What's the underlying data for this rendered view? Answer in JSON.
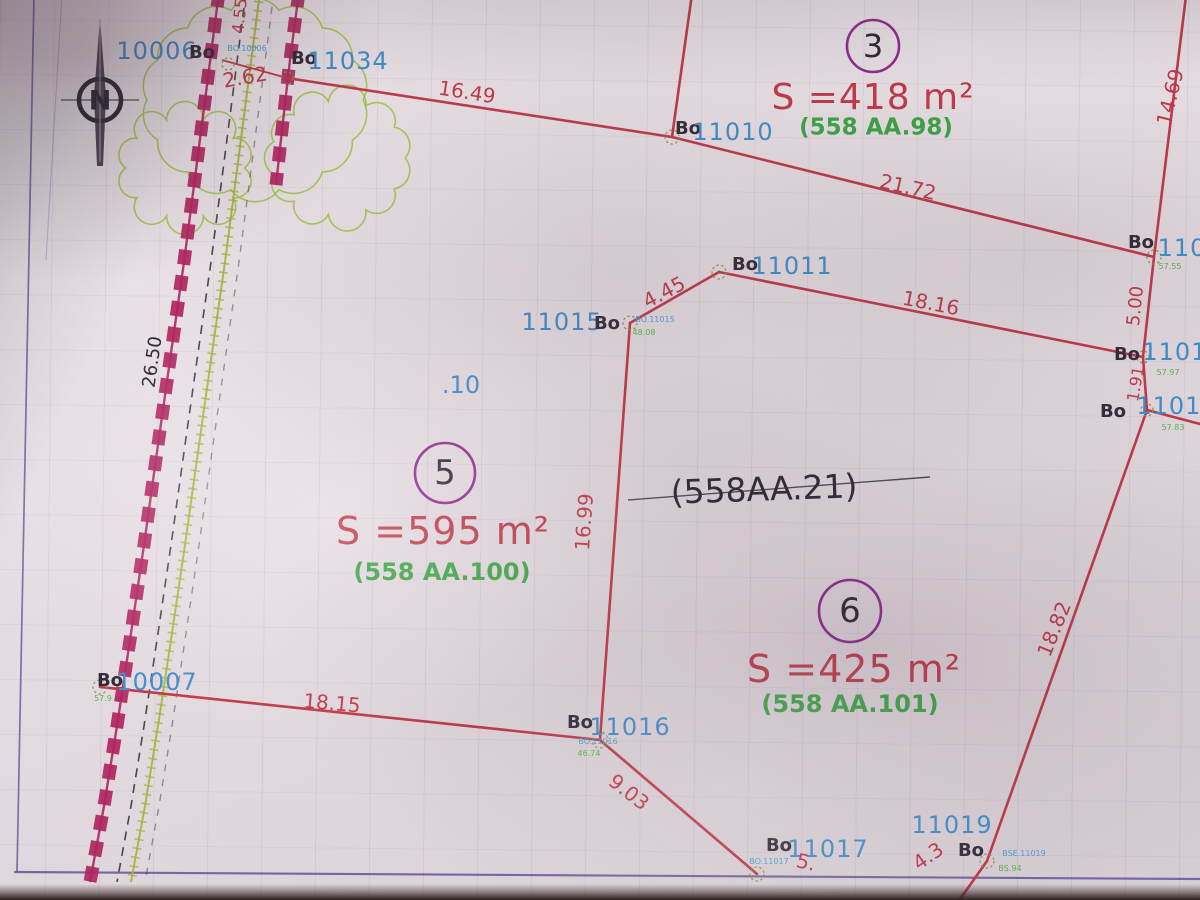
{
  "palette": {
    "paper": "#e8e0e4",
    "red": "#c03848",
    "blue": "#3e8ecb",
    "tinyblue": "#4aa4d8",
    "green": "#3aa543",
    "tinygreen": "#58b84a",
    "ink": "#2e2733",
    "dark": "#312a36",
    "magenta": "#b02560",
    "purple": "#8e2a8e",
    "olive": "#a8b23c",
    "treegreen": "#9cc53e",
    "frame": "#584d92",
    "marker": "#8f9440"
  },
  "north": {
    "label": "N"
  },
  "parcels": [
    {
      "number": "3",
      "area": "S =418 m²",
      "ref": "(558 AA.98)"
    },
    {
      "number": "5",
      "area": "S =595 m²",
      "ref": "(558 AA.100)"
    },
    {
      "number": "6",
      "area": "S =425 m²",
      "ref": "(558 AA.101)"
    }
  ],
  "crossed_out_ref": "(558AA.21)",
  "labels": [
    {
      "n": "point-label-10006",
      "t": "10006",
      "x": 157,
      "y": 51,
      "s": 24,
      "c": "blue",
      "ls": 1
    },
    {
      "n": "bo-prefix-10006",
      "t": "Bo",
      "x": 202,
      "y": 53,
      "s": 18,
      "c": "dark",
      "w": 700
    },
    {
      "n": "point-sublabel-10006",
      "t": "BO.10006",
      "x": 247,
      "y": 49,
      "s": 8,
      "c": "tinyblue"
    },
    {
      "n": "bo-prefix-11034",
      "t": "Bo",
      "x": 304,
      "y": 59,
      "s": 18,
      "c": "dark",
      "w": 700
    },
    {
      "n": "point-label-11034",
      "t": "11034",
      "x": 348,
      "y": 61,
      "s": 24,
      "c": "blue",
      "ls": 1
    },
    {
      "n": "dimension-2-62",
      "t": "2.62",
      "x": 245,
      "y": 77,
      "s": 20,
      "c": "red",
      "r": -10
    },
    {
      "n": "dimension-4-55",
      "t": "4.55",
      "x": 240,
      "y": 16,
      "s": 16,
      "c": "red",
      "r": -84
    },
    {
      "n": "dimension-26-50",
      "t": "26.50",
      "x": 153,
      "y": 362,
      "s": 18,
      "c": "ink",
      "r": -82
    },
    {
      "n": "dimension-16-49",
      "t": "16.49",
      "x": 467,
      "y": 92,
      "s": 20,
      "c": "red",
      "r": 9
    },
    {
      "n": "bo-prefix-11010",
      "t": "Bo",
      "x": 688,
      "y": 129,
      "s": 18,
      "c": "dark",
      "w": 700
    },
    {
      "n": "point-label-11010",
      "t": "11010",
      "x": 733,
      "y": 132,
      "s": 24,
      "c": "blue",
      "ls": 1
    },
    {
      "n": "dimension-21-72",
      "t": "21.72",
      "x": 908,
      "y": 187,
      "s": 20,
      "c": "red",
      "r": 13
    },
    {
      "n": "parcel-3-number",
      "bind": "parcels.0.number",
      "x": 873,
      "y": 46,
      "s": 32,
      "c": "ink"
    },
    {
      "n": "parcel-3-area",
      "bind": "parcels.0.area",
      "x": 873,
      "y": 98,
      "s": 36,
      "c": "red",
      "ls": 1
    },
    {
      "n": "parcel-3-ref",
      "bind": "parcels.0.ref",
      "x": 876,
      "y": 128,
      "s": 23,
      "c": "green",
      "w": 700
    },
    {
      "n": "dimension-14-69",
      "t": "14.69",
      "x": 1170,
      "y": 97,
      "s": 20,
      "c": "red",
      "r": -76
    },
    {
      "n": "bo-prefix-11012",
      "t": "Bo",
      "x": 1141,
      "y": 243,
      "s": 18,
      "c": "dark",
      "w": 700
    },
    {
      "n": "point-label-11012",
      "t": "110",
      "x": 1182,
      "y": 248,
      "s": 24,
      "c": "blue",
      "ls": 1
    },
    {
      "n": "point-sublabel-11012",
      "t": "57.55",
      "x": 1170,
      "y": 267,
      "s": 8,
      "c": "tinygreen"
    },
    {
      "n": "dimension-5-00",
      "t": "5.00",
      "x": 1136,
      "y": 306,
      "s": 18,
      "c": "red",
      "r": -84
    },
    {
      "n": "bo-prefix-11013",
      "t": "Bo",
      "x": 1127,
      "y": 355,
      "s": 18,
      "c": "dark",
      "w": 700
    },
    {
      "n": "point-label-11013",
      "t": "11013",
      "x": 1183,
      "y": 352,
      "s": 24,
      "c": "blue",
      "ls": 1
    },
    {
      "n": "point-sublabel-11013",
      "t": "57.97",
      "x": 1168,
      "y": 373,
      "s": 8,
      "c": "tinygreen"
    },
    {
      "n": "dimension-1-91",
      "t": "1.91",
      "x": 1136,
      "y": 384,
      "s": 16,
      "c": "red",
      "r": -80
    },
    {
      "n": "bo-prefix-11014",
      "t": "Bo",
      "x": 1113,
      "y": 412,
      "s": 18,
      "c": "dark",
      "w": 700
    },
    {
      "n": "point-label-11014",
      "t": "11014",
      "x": 1177,
      "y": 406,
      "s": 24,
      "c": "blue",
      "ls": 1
    },
    {
      "n": "point-sublabel-11014",
      "t": "57.83",
      "x": 1173,
      "y": 428,
      "s": 8,
      "c": "tinygreen"
    },
    {
      "n": "bo-prefix-11011",
      "t": "Bo",
      "x": 745,
      "y": 265,
      "s": 18,
      "c": "dark",
      "w": 700
    },
    {
      "n": "point-label-11011",
      "t": "11011",
      "x": 792,
      "y": 266,
      "s": 24,
      "c": "blue",
      "ls": 1
    },
    {
      "n": "dimension-4-45",
      "t": "4.45",
      "x": 664,
      "y": 292,
      "s": 20,
      "c": "red",
      "r": -28
    },
    {
      "n": "point-label-11015",
      "t": "11015",
      "x": 562,
      "y": 322,
      "s": 24,
      "c": "blue",
      "ls": 1
    },
    {
      "n": "bo-prefix-11015",
      "t": "Bo",
      "x": 607,
      "y": 324,
      "s": 18,
      "c": "dark",
      "w": 700
    },
    {
      "n": "point-sublabel-11015a",
      "t": "BO.11015",
      "x": 655,
      "y": 320,
      "s": 8,
      "c": "tinyblue"
    },
    {
      "n": "point-sublabel-11015b",
      "t": "48.08",
      "x": 644,
      "y": 333,
      "s": 8,
      "c": "tinygreen"
    },
    {
      "n": "point-label-10",
      "t": ".10",
      "x": 461,
      "y": 385,
      "s": 24,
      "c": "blue"
    },
    {
      "n": "dimension-18-16",
      "t": "18.16",
      "x": 931,
      "y": 303,
      "s": 20,
      "c": "red",
      "r": 11
    },
    {
      "n": "crossed-ref",
      "bind": "crossed_out_ref",
      "x": 764,
      "y": 489,
      "s": 33,
      "c": "ink",
      "r": -2
    },
    {
      "n": "parcel-5-number",
      "bind": "parcels.1.number",
      "x": 445,
      "y": 473,
      "s": 34,
      "c": "ink"
    },
    {
      "n": "parcel-5-area",
      "bind": "parcels.1.area",
      "x": 443,
      "y": 531,
      "s": 38,
      "c": "red",
      "ls": 1
    },
    {
      "n": "parcel-5-ref",
      "bind": "parcels.1.ref",
      "x": 442,
      "y": 572,
      "s": 24,
      "c": "green",
      "w": 700
    },
    {
      "n": "dimension-16-99",
      "t": "16.99",
      "x": 584,
      "y": 522,
      "s": 20,
      "c": "red",
      "r": -86
    },
    {
      "n": "parcel-6-number",
      "bind": "parcels.2.number",
      "x": 850,
      "y": 611,
      "s": 34,
      "c": "ink"
    },
    {
      "n": "parcel-6-area",
      "bind": "parcels.2.area",
      "x": 854,
      "y": 669,
      "s": 38,
      "c": "red",
      "ls": 1
    },
    {
      "n": "parcel-6-ref",
      "bind": "parcels.2.ref",
      "x": 850,
      "y": 704,
      "s": 24,
      "c": "green",
      "w": 700
    },
    {
      "n": "dimension-18-82",
      "t": "18.82",
      "x": 1054,
      "y": 629,
      "s": 20,
      "c": "red",
      "r": -68
    },
    {
      "n": "bo-prefix-10007",
      "t": "Bo",
      "x": 110,
      "y": 681,
      "s": 18,
      "c": "dark",
      "w": 700
    },
    {
      "n": "point-label-10007",
      "t": "10007",
      "x": 157,
      "y": 682,
      "s": 24,
      "c": "blue",
      "ls": 1
    },
    {
      "n": "point-sublabel-10007",
      "t": "57.9",
      "x": 103,
      "y": 699,
      "s": 8,
      "c": "tinygreen"
    },
    {
      "n": "dimension-18-15",
      "t": "18.15",
      "x": 332,
      "y": 703,
      "s": 20,
      "c": "red",
      "r": 5
    },
    {
      "n": "bo-prefix-11016",
      "t": "Bo",
      "x": 580,
      "y": 723,
      "s": 18,
      "c": "dark",
      "w": 700
    },
    {
      "n": "point-label-11016",
      "t": "11016",
      "x": 630,
      "y": 727,
      "s": 24,
      "c": "blue",
      "ls": 1
    },
    {
      "n": "point-sublabel-11016a",
      "t": "BO.11016",
      "x": 598,
      "y": 742,
      "s": 8,
      "c": "tinyblue"
    },
    {
      "n": "point-sublabel-11016b",
      "t": "46.74",
      "x": 589,
      "y": 754,
      "s": 8,
      "c": "tinygreen"
    },
    {
      "n": "dimension-9-03",
      "t": "9.03",
      "x": 629,
      "y": 792,
      "s": 20,
      "c": "red",
      "r": 38
    },
    {
      "n": "bo-prefix-11017",
      "t": "Bo",
      "x": 779,
      "y": 846,
      "s": 18,
      "c": "dark",
      "w": 700
    },
    {
      "n": "point-label-11017",
      "t": "11017",
      "x": 828,
      "y": 849,
      "s": 24,
      "c": "blue",
      "ls": 1
    },
    {
      "n": "point-sublabel-11017",
      "t": "BO.11017",
      "x": 769,
      "y": 862,
      "s": 8,
      "c": "tinyblue"
    },
    {
      "n": "dimension-5",
      "t": "5.",
      "x": 806,
      "y": 862,
      "s": 20,
      "c": "red",
      "r": 12
    },
    {
      "n": "point-label-11019",
      "t": "11019",
      "x": 952,
      "y": 825,
      "s": 24,
      "c": "blue",
      "ls": 1
    },
    {
      "n": "bo-prefix-11019",
      "t": "Bo",
      "x": 971,
      "y": 851,
      "s": 18,
      "c": "dark",
      "w": 700
    },
    {
      "n": "point-sublabel-11019a",
      "t": "BSE.11019",
      "x": 1024,
      "y": 854,
      "s": 8,
      "c": "tinyblue"
    },
    {
      "n": "point-sublabel-11019b",
      "t": "BS.94",
      "x": 1010,
      "y": 869,
      "s": 8,
      "c": "tinygreen"
    },
    {
      "n": "dimension-4-3",
      "t": "4.3",
      "x": 928,
      "y": 856,
      "s": 20,
      "c": "red",
      "r": -35
    },
    {
      "n": "north-label",
      "bind": "north.label",
      "x": 100,
      "y": 101,
      "s": 27,
      "c": "ink",
      "w": 700
    }
  ]
}
